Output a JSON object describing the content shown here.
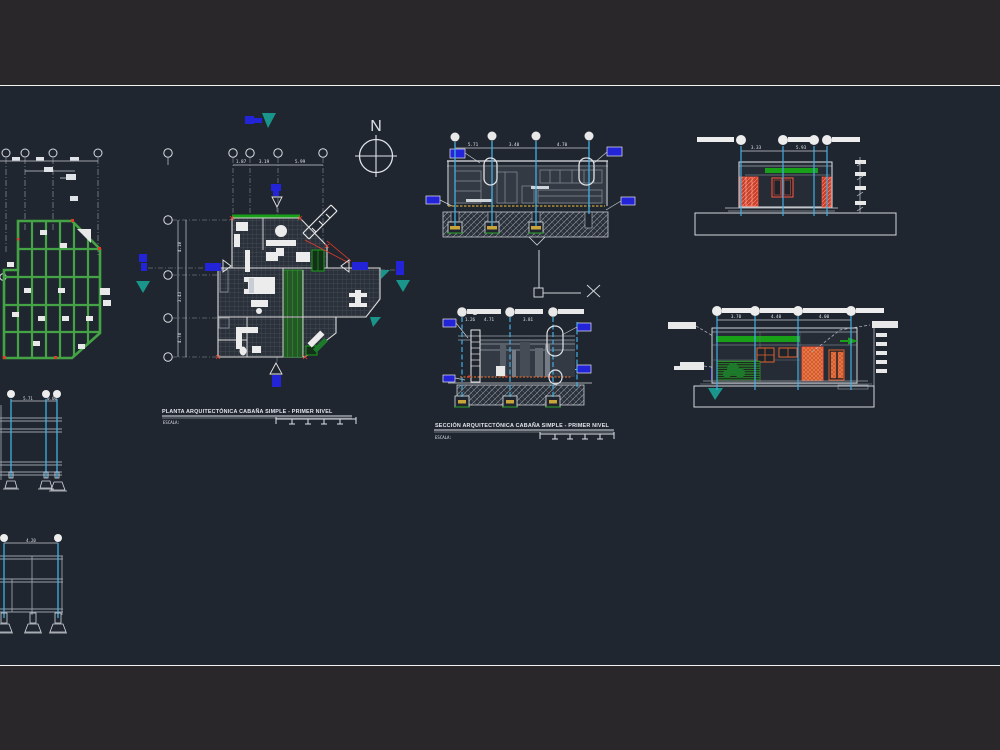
{
  "colors": {
    "background_outer": "#2a272b",
    "background_drawing": "#20262f",
    "frame_line": "#f2f2f2",
    "cad_white": "#e6e6e6",
    "cad_green": "#44a344",
    "cad_bright_green": "#18a118",
    "cad_red": "#e8402f",
    "cad_orange": "#e0622f",
    "cad_blue": "#2323d8",
    "cad_teal": "#1a958b",
    "cad_cyan": "#41aee4",
    "cad_yellow": "#c9a43a",
    "cad_gray": "#8a909a"
  },
  "north_arrow": {
    "label": "N"
  },
  "plan_view": {
    "title": "PLANTA ARQUITECTÓNICA CABAÑA SIMPLE - PRIMER NIVEL",
    "scale_label": "ESCALA:",
    "dims_top": [
      "1.87",
      "3.19",
      "5.99"
    ],
    "dims_left": [
      "4.10",
      "3.43",
      "4.78"
    ]
  },
  "section_view_top": {
    "dims": [
      "5.71",
      "3.40",
      "4.70"
    ]
  },
  "section_view_bottom": {
    "title": "SECCIÓN ARQUITECTÓNICA CABAÑA SIMPLE - PRIMER NIVEL",
    "scale_label": "ESCALA:",
    "dims": [
      "1.26",
      "4.71",
      "3.81"
    ]
  },
  "elevation_view_top": {
    "dims": [
      "3.33",
      "5.93"
    ]
  },
  "elevation_view_bottom": {
    "dims": [
      "3.70",
      "4.40",
      "4.00"
    ]
  },
  "frame_elevation_one": {
    "dims": [
      "5.71",
      "0.60"
    ]
  },
  "frame_elevation_two": {
    "dims": [
      "4.20"
    ]
  }
}
